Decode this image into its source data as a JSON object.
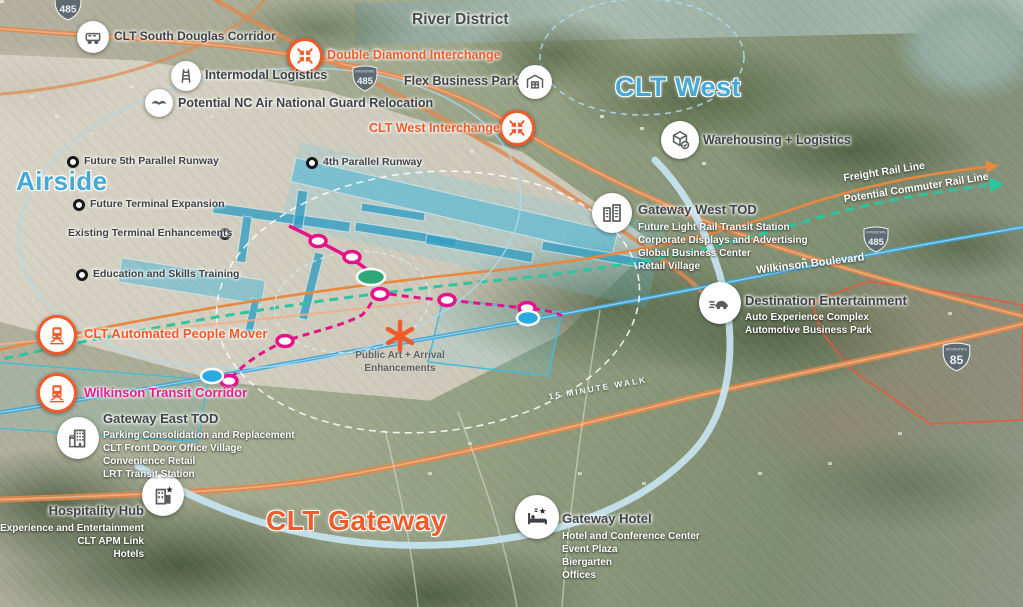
{
  "colors": {
    "orange_accent": "#F15A29",
    "pink_accent": "#EC1C8D",
    "blue_region": "#45A8D7",
    "teal_rail": "#2EC4A0",
    "charcoal_label": "#3F4247"
  },
  "map": {
    "region_titles": {
      "clt_west": "CLT West",
      "airside": "Airside",
      "clt_gateway": "CLT Gateway"
    },
    "labels": {
      "river_district": "River District",
      "wilkinson_boulevard": "Wilkinson Boulevard",
      "freight_rail": "Freight Rail Line",
      "commuter_rail": "Potential Commuter Rail Line",
      "walk_ring": "15 MINUTE WALK"
    },
    "shields": {
      "interstate_caption": "INTERSTATE",
      "i485": "485",
      "i85": "85"
    },
    "pois": {
      "south_douglas": {
        "title": "CLT South Douglas Corridor"
      },
      "double_diamond": {
        "title": "Double Diamond Interchange"
      },
      "intermodal": {
        "title": "Intermodal Logistics"
      },
      "flex_park": {
        "title": "Flex Business Park"
      },
      "air_guard": {
        "title": "Potential NC Air National Guard Relocation"
      },
      "west_interchange": {
        "title": "CLT West Interchange"
      },
      "warehousing": {
        "title": "Warehousing + Logistics"
      },
      "gateway_west": {
        "title": "Gateway West TOD",
        "items": [
          "Future Light Rail Transit Station",
          "Corporate Displays and Advertising",
          "Global Business Center",
          "Retail Village"
        ]
      },
      "destination": {
        "title": "Destination Entertainment",
        "items": [
          "Auto Experience Complex",
          "Automotive Business Park"
        ]
      },
      "apm": {
        "title": "CLT Automated People Mover"
      },
      "public_art": {
        "line1": "Public Art + Arrival",
        "line2": "Enhancements"
      },
      "wilkinson_transit": {
        "title": "Wilkinson Transit Corridor"
      },
      "gateway_east": {
        "title": "Gateway East TOD",
        "items": [
          "Parking Consolidation and Replacement",
          "CLT Front Door Office Village",
          "Convenience Retail",
          "LRT Transit Station"
        ]
      },
      "hospitality": {
        "title": "Hospitality Hub",
        "items": [
          "Experience and Entertainment",
          "CLT APM Link",
          "Hotels"
        ]
      },
      "gateway_hotel": {
        "title": "Gateway Hotel",
        "items": [
          "Hotel and Conference Center",
          "Event Plaza",
          "Biergarten",
          "Offices"
        ]
      }
    },
    "airside_items": {
      "runway5": "Future 5th Parallel Runway",
      "runway4": "4th Parallel Runway",
      "terminal_expansion": "Future Terminal Expansion",
      "terminal_enhancements": "Existing Terminal Enhancements",
      "education": "Education and Skills Training"
    }
  }
}
